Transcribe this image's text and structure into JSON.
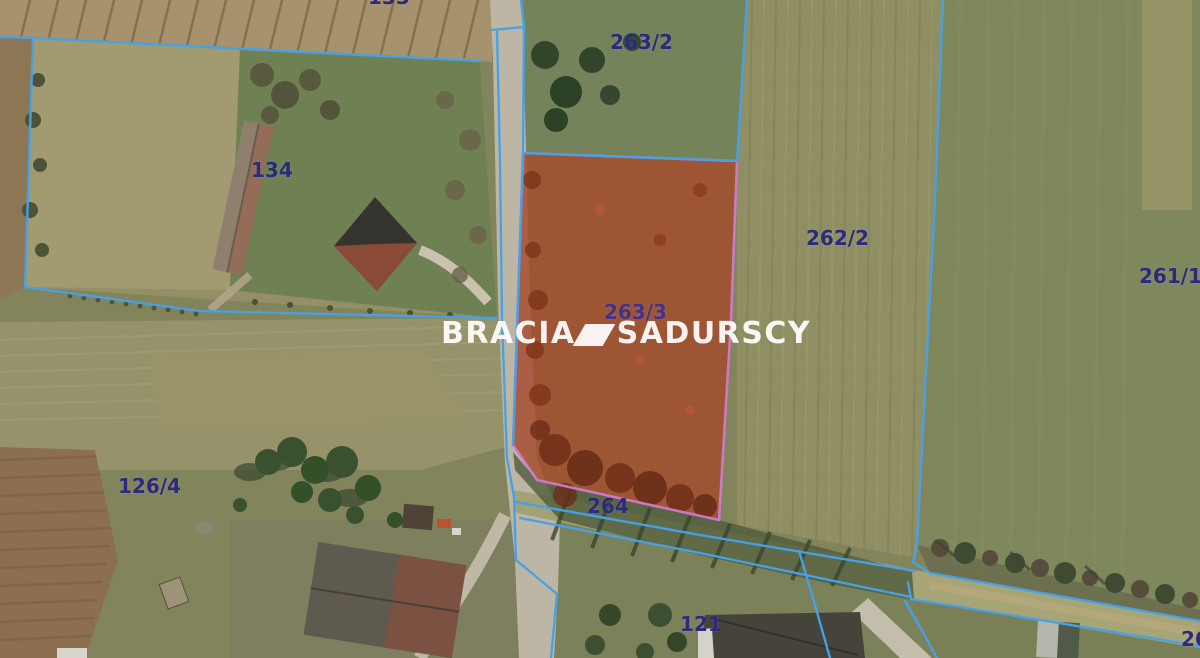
{
  "map": {
    "watermark": {
      "brand_left": "BRACIA",
      "brand_right": "SADURSCY"
    },
    "parcel_labels": {
      "p133": "133",
      "p134": "134",
      "p263_2": "263/2",
      "p262_2": "262/2",
      "p261_1": "261/1",
      "p263_3": "263/3",
      "p264": "264",
      "p126_4": "126/4",
      "p121": "121",
      "p26_partial": "26"
    },
    "highlighted_parcel": {
      "number": "263/3",
      "fill_color": "#a5492a",
      "border_color": "#cf7ad0"
    },
    "colors": {
      "boundary_line": "#45a1e8",
      "label_text": "#2b2a7e",
      "watermark_text": "#ffffff"
    }
  }
}
